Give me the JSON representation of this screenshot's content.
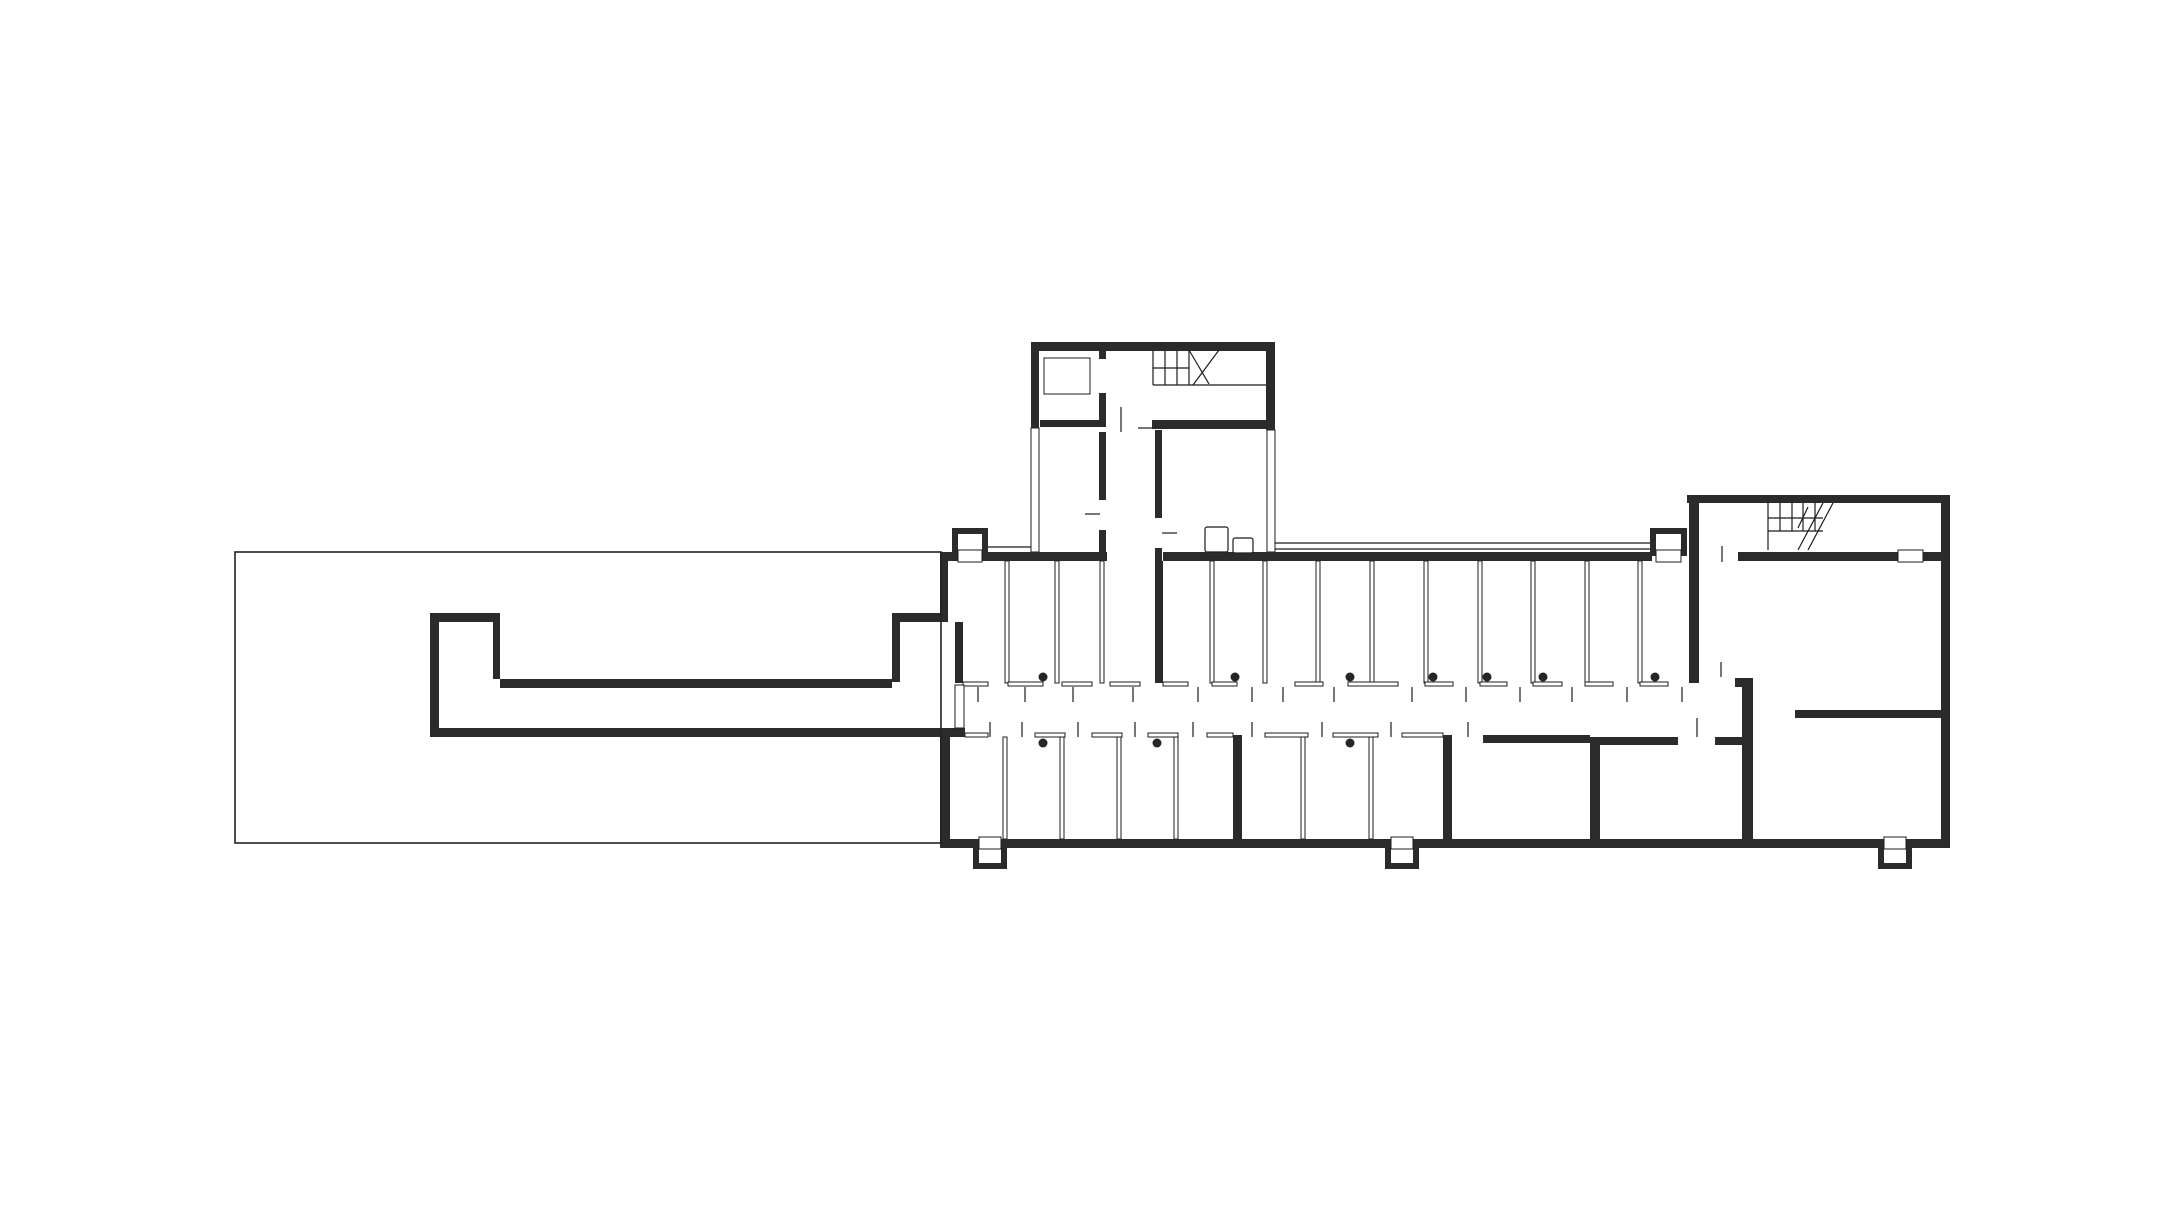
{
  "canvas": {
    "width": 2182,
    "height": 1220,
    "background": "#ffffff"
  },
  "palette": {
    "wall": "#2b2b2b",
    "line": "#1c1c1c",
    "thin_stroke": "#1c1c1c",
    "outline": "#222222",
    "dot": "#262626",
    "paper": "#ffffff"
  },
  "layers": {
    "outline_rects": [
      [
        235,
        552,
        706,
        291
      ]
    ],
    "thin_rects": [
      [
        1031,
        428,
        8,
        124
      ],
      [
        1267,
        430,
        8,
        122
      ],
      [
        1044,
        358,
        46,
        36
      ],
      [
        1005,
        561,
        4,
        122
      ],
      [
        1055,
        561,
        4,
        122
      ],
      [
        1100,
        561,
        4,
        122
      ],
      [
        1210,
        561,
        4,
        122
      ],
      [
        1263,
        561,
        4,
        122
      ],
      [
        1316,
        561,
        4,
        122
      ],
      [
        1370,
        561,
        4,
        122
      ],
      [
        1424,
        561,
        4,
        122
      ],
      [
        1478,
        561,
        4,
        122
      ],
      [
        1531,
        561,
        4,
        122
      ],
      [
        1585,
        561,
        4,
        122
      ],
      [
        1638,
        561,
        4,
        122
      ],
      [
        1003,
        737,
        4,
        102
      ],
      [
        1060,
        737,
        4,
        102
      ],
      [
        1117,
        737,
        4,
        102
      ],
      [
        1174,
        737,
        4,
        102
      ],
      [
        1301,
        737,
        4,
        102
      ],
      [
        1369,
        737,
        4,
        102
      ],
      [
        963,
        682,
        25,
        4
      ],
      [
        1008,
        682,
        35,
        4
      ],
      [
        1062,
        682,
        30,
        4
      ],
      [
        1110,
        682,
        30,
        4
      ],
      [
        1163,
        682,
        25,
        4
      ],
      [
        1212,
        682,
        25,
        4
      ],
      [
        1295,
        682,
        28,
        4
      ],
      [
        1348,
        682,
        50,
        4
      ],
      [
        1425,
        682,
        28,
        4
      ],
      [
        1480,
        682,
        27,
        4
      ],
      [
        1533,
        682,
        29,
        4
      ],
      [
        1585,
        682,
        28,
        4
      ],
      [
        1640,
        682,
        28,
        4
      ],
      [
        965,
        733,
        23,
        4
      ],
      [
        1035,
        733,
        30,
        4
      ],
      [
        1092,
        733,
        30,
        4
      ],
      [
        1148,
        733,
        30,
        4
      ],
      [
        1207,
        733,
        26,
        4
      ],
      [
        1265,
        733,
        43,
        4
      ],
      [
        1333,
        733,
        45,
        4
      ],
      [
        1402,
        733,
        41,
        4
      ]
    ],
    "walls": [
      [
        940,
        552,
        167,
        9
      ],
      [
        1163,
        552,
        489,
        9
      ],
      [
        1738,
        552,
        160,
        9
      ],
      [
        1923,
        552,
        27,
        9
      ],
      [
        940,
        839,
        1010,
        9
      ],
      [
        940,
        552,
        8,
        70
      ],
      [
        892,
        613,
        56,
        9
      ],
      [
        892,
        622,
        8,
        60
      ],
      [
        955,
        622,
        8,
        61
      ],
      [
        940,
        728,
        10,
        111
      ],
      [
        940,
        728,
        25,
        9
      ],
      [
        1941,
        495,
        9,
        353
      ],
      [
        500,
        679,
        392,
        9
      ],
      [
        430,
        613,
        70,
        9
      ],
      [
        493,
        622,
        7,
        57
      ],
      [
        430,
        613,
        9,
        124
      ],
      [
        430,
        728,
        535,
        9
      ],
      [
        1031,
        342,
        244,
        9
      ],
      [
        1031,
        342,
        8,
        86
      ],
      [
        1266,
        342,
        9,
        88
      ],
      [
        1152,
        420,
        123,
        9
      ],
      [
        1040,
        420,
        59,
        7
      ],
      [
        1099,
        351,
        7,
        8
      ],
      [
        1099,
        393,
        7,
        34
      ],
      [
        1099,
        432,
        7,
        68
      ],
      [
        1099,
        530,
        7,
        22
      ],
      [
        1155,
        430,
        7,
        88
      ],
      [
        1155,
        548,
        7,
        13
      ],
      [
        1155,
        561,
        8,
        122
      ],
      [
        1687,
        495,
        263,
        8
      ],
      [
        1689,
        495,
        10,
        188
      ],
      [
        1795,
        710,
        146,
        8
      ],
      [
        1233,
        735,
        9,
        104
      ],
      [
        1443,
        735,
        9,
        104
      ],
      [
        1483,
        735,
        107,
        8
      ],
      [
        1590,
        737,
        10,
        102
      ],
      [
        1600,
        737,
        78,
        8
      ],
      [
        1715,
        737,
        27,
        8
      ],
      [
        1742,
        678,
        11,
        161
      ],
      [
        1735,
        678,
        18,
        9
      ],
      [
        952,
        528,
        6,
        28
      ],
      [
        982,
        528,
        6,
        28
      ],
      [
        952,
        528,
        36,
        6
      ],
      [
        1650,
        528,
        6,
        28
      ],
      [
        1681,
        528,
        6,
        28
      ],
      [
        1650,
        528,
        37,
        6
      ],
      [
        973,
        845,
        6,
        24
      ],
      [
        1001,
        845,
        6,
        24
      ],
      [
        973,
        863,
        34,
        6
      ],
      [
        1385,
        845,
        6,
        24
      ],
      [
        1413,
        845,
        6,
        24
      ],
      [
        1385,
        863,
        34,
        6
      ],
      [
        1878,
        845,
        6,
        24
      ],
      [
        1906,
        845,
        6,
        24
      ],
      [
        1878,
        863,
        34,
        6
      ]
    ],
    "openings": [
      [
        955,
        685,
        9,
        43
      ],
      [
        958,
        550,
        24,
        12
      ],
      [
        1656,
        550,
        25,
        12
      ],
      [
        1898,
        550,
        25,
        12
      ],
      [
        979,
        837,
        22,
        12
      ],
      [
        1391,
        837,
        22,
        12
      ],
      [
        1884,
        837,
        22,
        12
      ]
    ],
    "lines": [
      [
        978,
        687,
        978,
        702
      ],
      [
        1025,
        687,
        1025,
        702
      ],
      [
        1073,
        687,
        1073,
        702
      ],
      [
        1133,
        687,
        1133,
        702
      ],
      [
        1198,
        687,
        1198,
        702
      ],
      [
        1252,
        687,
        1252,
        702
      ],
      [
        1283,
        687,
        1283,
        702
      ],
      [
        1334,
        687,
        1334,
        702
      ],
      [
        1412,
        687,
        1412,
        702
      ],
      [
        1466,
        687,
        1466,
        702
      ],
      [
        1520,
        687,
        1520,
        702
      ],
      [
        1572,
        687,
        1572,
        702
      ],
      [
        1627,
        687,
        1627,
        702
      ],
      [
        1682,
        687,
        1682,
        702
      ],
      [
        990,
        722,
        990,
        737
      ],
      [
        1022,
        722,
        1022,
        737
      ],
      [
        1078,
        722,
        1078,
        737
      ],
      [
        1135,
        722,
        1135,
        737
      ],
      [
        1193,
        722,
        1193,
        737
      ],
      [
        1252,
        722,
        1252,
        737
      ],
      [
        1322,
        722,
        1322,
        737
      ],
      [
        1391,
        722,
        1391,
        737
      ],
      [
        1468,
        722,
        1468,
        737
      ],
      [
        1697,
        718,
        1697,
        737
      ],
      [
        1721,
        662,
        1721,
        677
      ],
      [
        1722,
        546,
        1722,
        562
      ],
      [
        1121,
        407,
        1121,
        432
      ],
      [
        1085,
        514,
        1100,
        514
      ],
      [
        1162,
        533,
        1177,
        533
      ],
      [
        1138,
        428,
        1152,
        428
      ],
      [
        988,
        547,
        1031,
        547
      ],
      [
        1275,
        543,
        1650,
        543
      ],
      [
        1275,
        549,
        1650,
        549
      ],
      [
        1153,
        351,
        1153,
        385
      ],
      [
        1165,
        351,
        1165,
        385
      ],
      [
        1177,
        351,
        1177,
        385
      ],
      [
        1189,
        351,
        1189,
        385
      ],
      [
        1153,
        368,
        1189,
        368
      ],
      [
        1153,
        385,
        1266,
        385
      ],
      [
        1189,
        350,
        1209,
        384
      ],
      [
        1219,
        350,
        1193,
        385
      ],
      [
        1768,
        503,
        1768,
        550
      ],
      [
        1780,
        503,
        1780,
        531
      ],
      [
        1792,
        503,
        1792,
        531
      ],
      [
        1803,
        503,
        1803,
        531
      ],
      [
        1815,
        503,
        1815,
        531
      ],
      [
        1768,
        518,
        1823,
        518
      ],
      [
        1768,
        531,
        1823,
        531
      ],
      [
        1823,
        503,
        1798,
        550
      ],
      [
        1833,
        503,
        1808,
        550
      ],
      [
        1808,
        507,
        1798,
        528
      ]
    ],
    "dots": [
      [
        1043,
        677
      ],
      [
        1235,
        677
      ],
      [
        1350,
        677
      ],
      [
        1433,
        677
      ],
      [
        1487,
        677
      ],
      [
        1543,
        677
      ],
      [
        1655,
        677
      ],
      [
        1043,
        743
      ],
      [
        1157,
        743
      ],
      [
        1350,
        743
      ]
    ],
    "furniture": [
      [
        1205,
        527,
        23,
        25,
        2
      ],
      [
        1233,
        538,
        20,
        15,
        2
      ]
    ]
  }
}
